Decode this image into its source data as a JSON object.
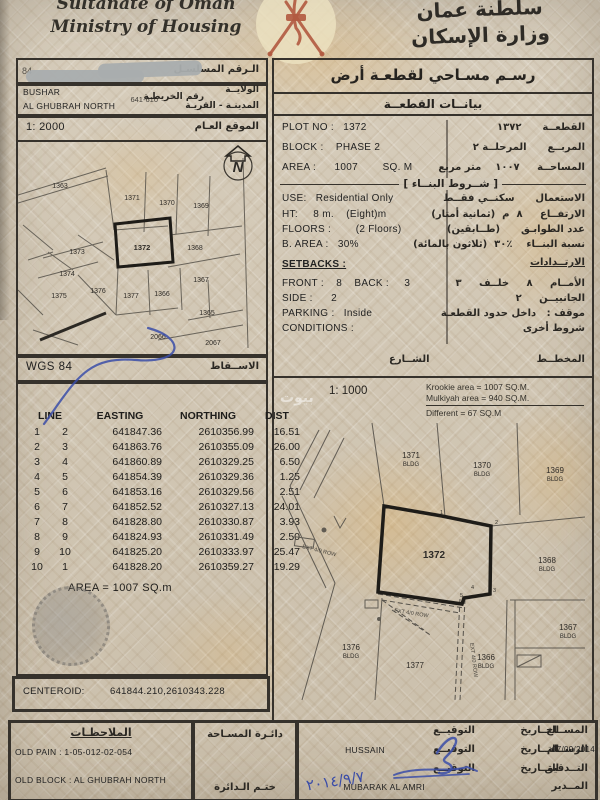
{
  "header": {
    "title_en_1": "Sultanate of Oman",
    "title_en_2": "Ministry of Housing",
    "title_ar_1": "سلطنة عمان",
    "title_ar_2": "وزارة الإسكان"
  },
  "ident": {
    "serial_label_ar": "الـرقم المسلسـل",
    "wilaya_value": "BUSHAR",
    "wilaya_label_ar": "الولايــة",
    "map_no_value": "641-610",
    "map_no_label_ar": "رقم الخريطـة",
    "town_value": "AL GHUBRAH NORTH",
    "town_label_ar": "المدينـة - القريـة"
  },
  "doc_title_ar": "رسـم مسـاحي لقطعـة أرض",
  "plot_info_header_ar": "بيانــات القطعــة",
  "general_map": {
    "scale": "1: 2000",
    "label_ar": "الموقع العـام",
    "north_letter": "N",
    "plots": [
      {
        "label": "1363",
        "x": 42,
        "y": 48
      },
      {
        "label": "1371",
        "x": 114,
        "y": 60
      },
      {
        "label": "1370",
        "x": 149,
        "y": 65
      },
      {
        "label": "1369",
        "x": 183,
        "y": 68
      },
      {
        "label": "1372",
        "x": 124,
        "y": 110,
        "bold": true
      },
      {
        "label": "1368",
        "x": 177,
        "y": 110
      },
      {
        "label": "1373",
        "x": 59,
        "y": 114
      },
      {
        "label": "1374",
        "x": 49,
        "y": 136
      },
      {
        "label": "1375",
        "x": 41,
        "y": 158
      },
      {
        "label": "1376",
        "x": 80,
        "y": 153
      },
      {
        "label": "1377",
        "x": 113,
        "y": 158
      },
      {
        "label": "1366",
        "x": 144,
        "y": 156
      },
      {
        "label": "1367",
        "x": 183,
        "y": 142
      },
      {
        "label": "1365",
        "x": 189,
        "y": 175
      },
      {
        "label": "2066",
        "x": 140,
        "y": 199
      },
      {
        "label": "2067",
        "x": 195,
        "y": 205
      }
    ]
  },
  "projection": {
    "value": "WGS 84",
    "label_ar": "الاســقاط"
  },
  "coords": {
    "headers": [
      "LINE",
      "EASTING",
      "NORTHING",
      "DIST"
    ],
    "rows": [
      [
        "1",
        "2",
        "641847.36",
        "2610356.99",
        "16.51"
      ],
      [
        "2",
        "3",
        "641863.76",
        "2610355.09",
        "26.00"
      ],
      [
        "3",
        "4",
        "641860.89",
        "2610329.25",
        "6.50"
      ],
      [
        "4",
        "5",
        "641854.39",
        "2610329.36",
        "1.25"
      ],
      [
        "5",
        "6",
        "641853.16",
        "2610329.56",
        "2.51"
      ],
      [
        "6",
        "7",
        "641852.52",
        "2610327.13",
        "24.01"
      ],
      [
        "7",
        "8",
        "641828.80",
        "2610330.87",
        "3.93"
      ],
      [
        "8",
        "9",
        "641824.93",
        "2610331.49",
        "2.50"
      ],
      [
        "9",
        "10",
        "641825.20",
        "2610333.97",
        "25.47"
      ],
      [
        "10",
        "1",
        "641828.20",
        "2610359.27",
        "19.29"
      ]
    ],
    "area_text": "AREA = 1007  SQ.m"
  },
  "centeroid": {
    "label": "CENTEROID:",
    "value": "641844.210,2610343.228"
  },
  "plot_data": {
    "rows": [
      {
        "en": "PLOT NO :   1372",
        "ar": "القطعــة      ١٣٧٢"
      },
      {
        "en": "BLOCK :    PHASE 2",
        "ar": "المربــع      المرحلــة ٢"
      },
      {
        "en": "AREA :      1007        SQ. M",
        "ar": "المساحــة     ١٠٠٧    متر مربع"
      }
    ],
    "building_header_ar": "[ شــروط البنــاء ]",
    "building_rows": [
      {
        "en": "USE:   Residential Only",
        "ar": "الاستعمال      سكنــي فقــط"
      },
      {
        "en": "HT:     8 m.    (Eight)m",
        "ar": "الارتفــاع     ٨  م  (ثمانية أمتار)"
      },
      {
        "en": "FLOORS :        (2 Floors)",
        "ar": "عدد الطوابـق      (طــابقين)"
      },
      {
        "en": "B. AREA :   30%",
        "ar": "نسبة البنــاء    ٪٣٠  (ثلاثون بالمائة)"
      }
    ],
    "setbacks_en": "SETBACKS :",
    "setbacks_ar": "الارتــدادات",
    "setback_rows": [
      {
        "en": "FRONT :    8    BACK :     3",
        "ar": "الأمــام     ٨     خلــف     ٣"
      },
      {
        "en": "SIDE :      2",
        "ar": "الجانبيــن     ٢"
      },
      {
        "en": "PARKING :   Inside",
        "ar": "موقف :   داخل حدود القطعـة"
      },
      {
        "en": "CONDITIONS :",
        "ar": "شروط أخرى"
      }
    ],
    "street_ar": "الشــارع",
    "plan_ar": "المخطــط"
  },
  "detail_map": {
    "scale": "1: 1000",
    "krookie_line": "Krookie   area = 1007 SQ.M.",
    "mulkiyah_line": "Mulkiyah  area = 940 SQ.M.",
    "different_line": "Different         = 67 SQ.M",
    "watermark": "بيوت",
    "road_label": "EXT 4/0 ROW",
    "plots": [
      {
        "label": "1371",
        "x": 137,
        "y": 80,
        "sub": "BLDG"
      },
      {
        "label": "1370",
        "x": 208,
        "y": 90,
        "sub": "BLDG"
      },
      {
        "label": "1369",
        "x": 281,
        "y": 95,
        "sub": "BLDG"
      },
      {
        "label": "1372",
        "x": 160,
        "y": 180,
        "bold": true
      },
      {
        "label": "1368",
        "x": 273,
        "y": 185,
        "sub": "BLDG"
      },
      {
        "label": "1367",
        "x": 294,
        "y": 252,
        "sub": "BLDG"
      },
      {
        "label": "1376",
        "x": 77,
        "y": 272,
        "sub": "BLDG"
      },
      {
        "label": "1377",
        "x": 141,
        "y": 290
      },
      {
        "label": "1366",
        "x": 212,
        "y": 282,
        "sub": "BLDG"
      }
    ],
    "verts": [
      {
        "label": "1",
        "x": 166,
        "y": 136
      },
      {
        "label": "2",
        "x": 221,
        "y": 146
      },
      {
        "label": "3",
        "x": 219,
        "y": 214
      },
      {
        "label": "4",
        "x": 197,
        "y": 211
      },
      {
        "label": "5",
        "x": 186,
        "y": 219
      }
    ]
  },
  "footer": {
    "notes_label_ar": "الملاحظـات",
    "old_pain": "OLD PAIN : 1-05-012-02-054",
    "old_block": "OLD BLOCK : AL GHUBRAH NORTH",
    "dept_ar": "دائـرة المسـاحة",
    "stamp_ar": "ختـم الـدائرة",
    "sig_label_ar": "التوقيــع",
    "date_label_ar": "التــاريخ",
    "rows": [
      {
        "role_ar": "المســاح",
        "name": ""
      },
      {
        "role_ar": "الرســام",
        "name": "HUSSAIN",
        "date": "07/09/2014"
      },
      {
        "role_ar": "التــدقيق",
        "name": ""
      },
      {
        "role_ar": "المــدير",
        "name": "MUBARAK AL AMRI"
      }
    ],
    "hand_date": "٢٠١٤/٩/٧"
  }
}
